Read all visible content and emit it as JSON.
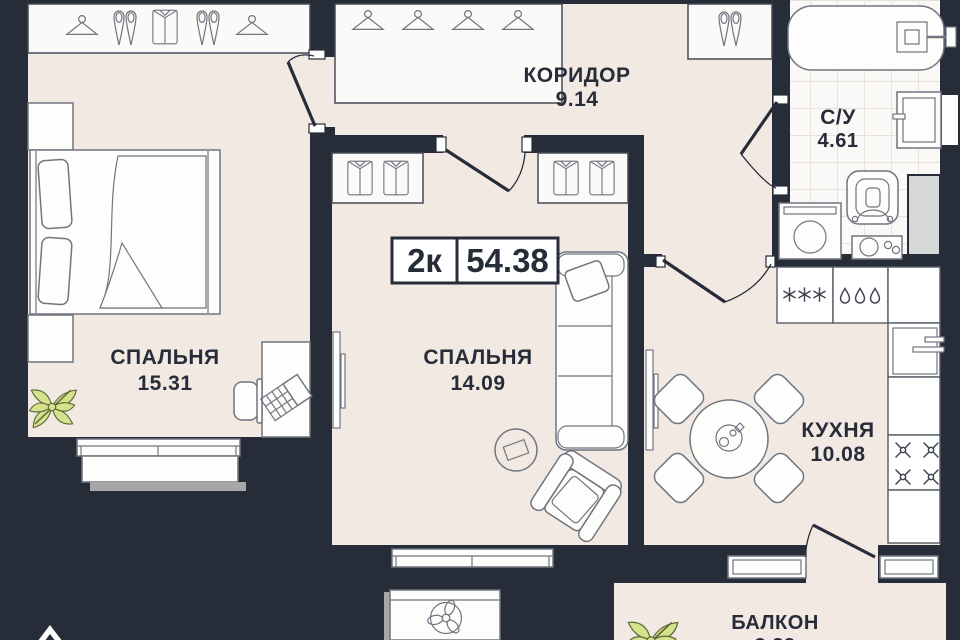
{
  "plan": {
    "badge": {
      "rooms": "2к",
      "area": "54.38"
    },
    "rooms": {
      "bedroom1": {
        "name": "СПАЛЬНЯ",
        "area": "15.31"
      },
      "corridor": {
        "name": "КОРИДОР",
        "area": "9.14"
      },
      "bathroom": {
        "name": "С/У",
        "area": "4.61"
      },
      "bedroom2": {
        "name": "СПАЛЬНЯ",
        "area": "14.09"
      },
      "kitchen": {
        "name": "КУХНЯ",
        "area": "10.08"
      },
      "balcony": {
        "name": "БАЛКОН",
        "area": "3.83"
      }
    },
    "icons": {
      "hanger": "clothes-hanger",
      "shoes": "pair-of-shoes",
      "shirt": "folded-shirt",
      "snowflake": "fridge-freezer",
      "drops": "sink-drops",
      "burner": "stove-burner",
      "fan": "ac-fan",
      "kettle": "kettle-on-table",
      "plant": "green-plant",
      "compass": "north-arrow"
    },
    "colors": {
      "background": "#272c39",
      "floor": "#f2e9e3",
      "text": "#272c39",
      "plant": "#d6e18c"
    }
  }
}
